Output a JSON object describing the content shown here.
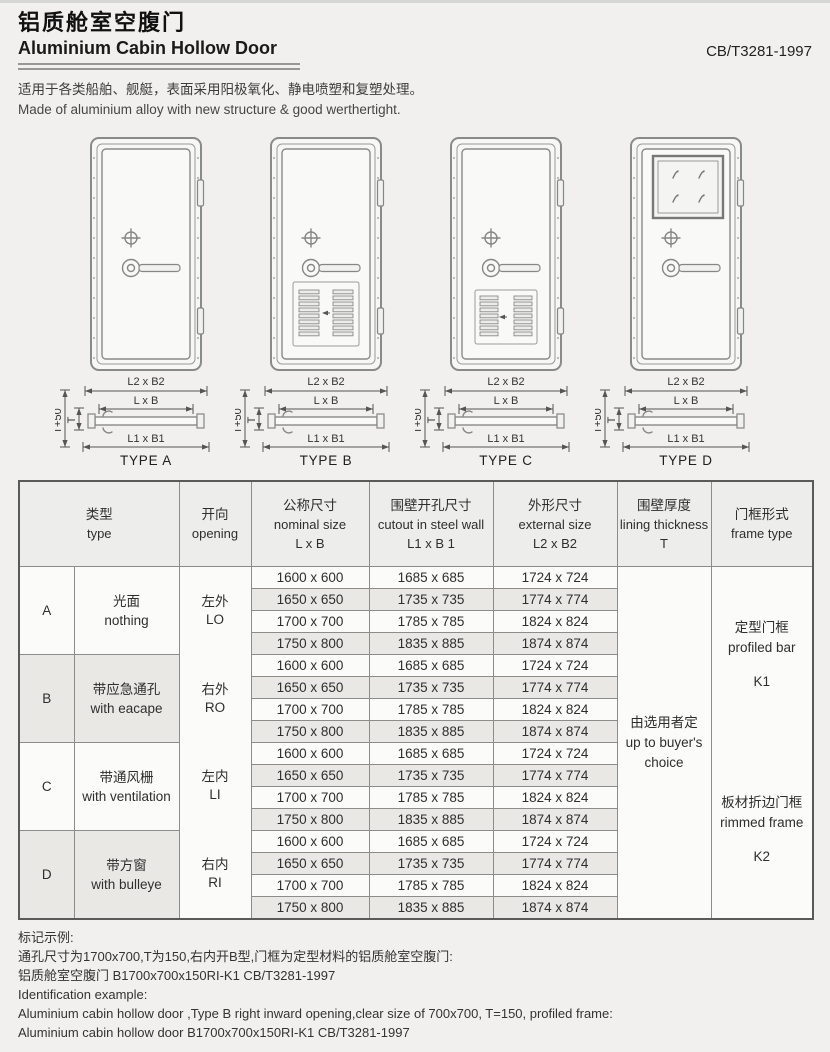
{
  "header": {
    "title_zh": "铝质舱室空腹门",
    "title_en": "Aluminium Cabin Hollow Door",
    "standard": "CB/T3281-1997",
    "desc_zh": "适用于各类船舶、舰艇，表面采用阳极氧化、静电喷塑和复塑处理。",
    "desc_en": "Made of aluminium alloy with new structure & good werthertight."
  },
  "diagrams": {
    "dim_labels": {
      "outer": "L2 x B2",
      "nominal": "L x B",
      "cutout": "L1 x B1",
      "t50": "T+50",
      "t": "T"
    },
    "types": [
      {
        "id": "a",
        "label": "TYPE A",
        "feature": "plain"
      },
      {
        "id": "b",
        "label": "TYPE B",
        "feature": "escape-vent-panel"
      },
      {
        "id": "c",
        "label": "TYPE C",
        "feature": "ventilation-grille"
      },
      {
        "id": "d",
        "label": "TYPE D",
        "feature": "square-window"
      }
    ]
  },
  "table": {
    "headers": {
      "type": {
        "zh": "类型",
        "en": "type"
      },
      "opening": {
        "zh": "开向",
        "en": "opening"
      },
      "nominal": {
        "zh": "公称尺寸",
        "en": "nominal size",
        "formula": "L x B"
      },
      "cutout": {
        "zh": "围壁开孔尺寸",
        "en": "cutout in steel wall",
        "formula": "L1 x B 1"
      },
      "external": {
        "zh": "外形尺寸",
        "en": "external  size",
        "formula": "L2 x B2"
      },
      "lining": {
        "zh": "围壁厚度",
        "en": "lining thickness",
        "formula": "T"
      },
      "frame": {
        "zh": "门框形式",
        "en": "frame type"
      }
    },
    "groups": [
      {
        "letter": "A",
        "zh": "光面",
        "en": "nothing"
      },
      {
        "letter": "B",
        "zh": "带应急通孔",
        "en": "with eacape"
      },
      {
        "letter": "C",
        "zh": "带通风栅",
        "en": "with ventilation"
      },
      {
        "letter": "D",
        "zh": "带方窗",
        "en": "with bulleye"
      }
    ],
    "openings": [
      {
        "zh": "左外",
        "en": "LO"
      },
      {
        "zh": "右外",
        "en": "RO"
      },
      {
        "zh": "左内",
        "en": "LI"
      },
      {
        "zh": "右内",
        "en": "RI"
      }
    ],
    "sizes": [
      {
        "nominal": "1600 x 600",
        "cutout": "1685 x 685",
        "external": "1724 x 724"
      },
      {
        "nominal": "1650 x 650",
        "cutout": "1735 x 735",
        "external": "1774 x 774"
      },
      {
        "nominal": "1700 x 700",
        "cutout": "1785 x 785",
        "external": "1824 x 824"
      },
      {
        "nominal": "1750 x 800",
        "cutout": "1835 x 885",
        "external": "1874 x 874"
      }
    ],
    "lining": {
      "zh": "由选用者定",
      "en": "up to buyer's",
      "en2": "choice"
    },
    "frames": [
      {
        "zh": "定型门框",
        "en": "profiled bar",
        "code": "K1"
      },
      {
        "zh": "板材折边门框",
        "en": "rimmed frame",
        "code": "K2"
      }
    ]
  },
  "footer": {
    "zh_title": "标记示例:",
    "zh_line1": "通孔尺寸为1700x700,T为150,右内开B型,门框为定型材料的铝质舱室空腹门:",
    "zh_line2": "铝质舱室空腹门 B1700x700x150RI-K1 CB/T3281-1997",
    "en_title": "Identification example:",
    "en_line1": "Aluminium cabin hollow door ,Type B right inward opening,clear size of 700x700, T=150, profiled frame:",
    "en_line2": "Aluminium cabin hollow door B1700x700x150RI-K1 CB/T3281-1997"
  },
  "colors": {
    "page_bg": "#f1f0ee",
    "stripe": "#e9e8e5",
    "header_bg": "#ededeb",
    "border": "#8c8c8a",
    "line_art": "#8a8a8a"
  }
}
